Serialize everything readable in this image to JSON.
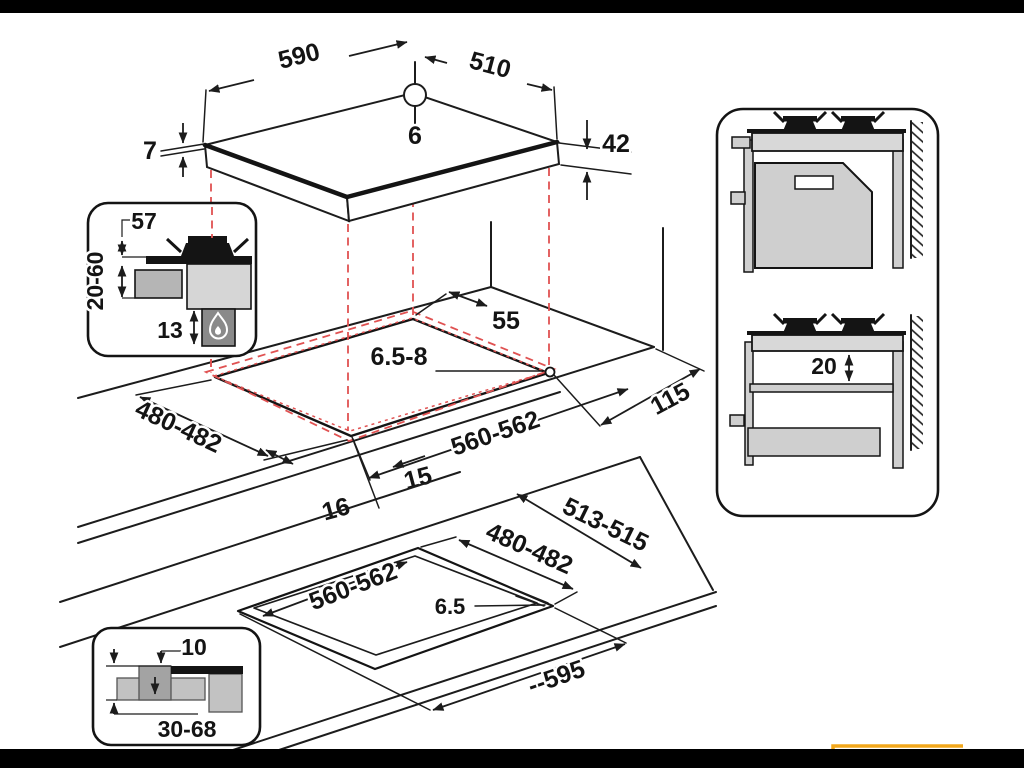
{
  "window": {
    "background": "#ffffff",
    "letterbox_color": "#000000",
    "accent_yellow": "#f2a71b",
    "line_color": "#1c1c1c",
    "projection_red": "#e05252"
  },
  "diagram": {
    "top_view": {
      "width": "590",
      "depth": "510",
      "hole_offset": "6",
      "glass_thickness": "7",
      "body_height": "42"
    },
    "cutout_view": {
      "back_gap": "55",
      "hole_diameter": "6.5-8",
      "side_clearance": "115",
      "cutout_depth": "480-482",
      "cutout_width": "560-562",
      "front_gap_right": "15",
      "front_gap_left": "16"
    },
    "burner_inset": {
      "burner_width": "57",
      "worktop_thickness": "20-60",
      "burner_depth": "13"
    },
    "flush_view": {
      "recess_depth": "513-515",
      "cutout_depth": "480-482",
      "cutout_width": "560-562",
      "flange_depth": "6.5",
      "overall_width": "--595"
    },
    "edge_inset": {
      "flange_gap": "10",
      "worktop_range": "30-68"
    },
    "side_view": {
      "shelf_clearance": "20"
    }
  }
}
